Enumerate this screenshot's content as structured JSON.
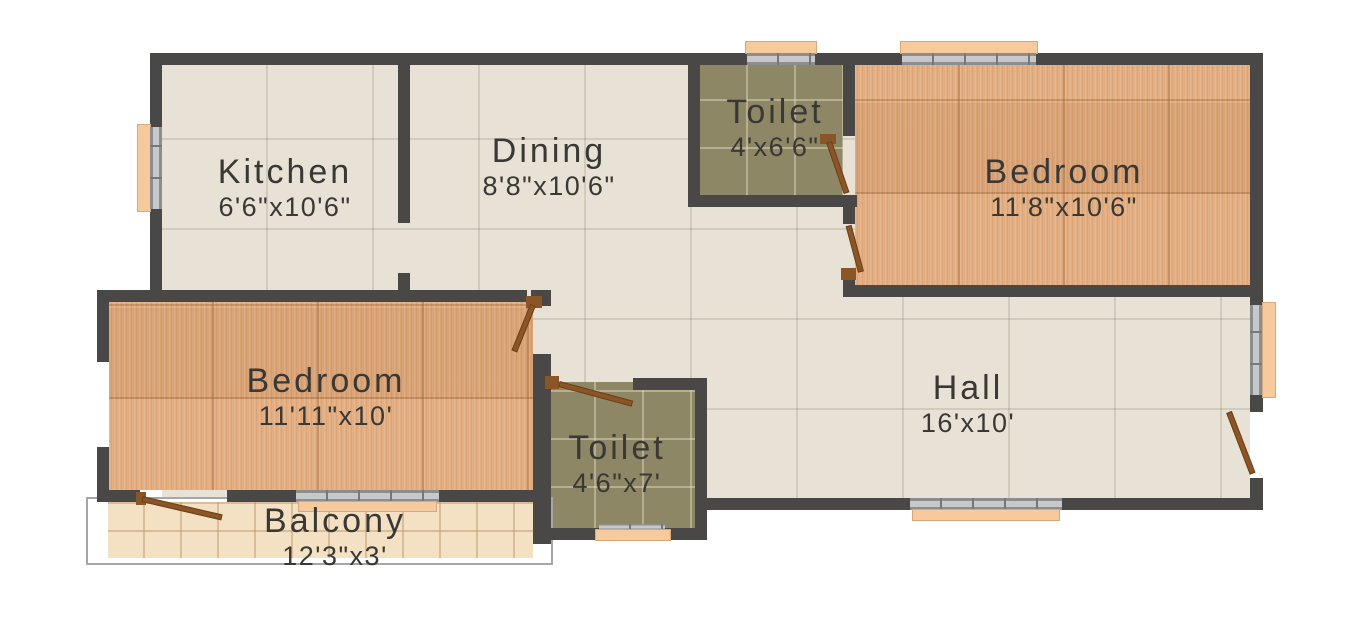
{
  "plan": {
    "rooms": [
      {
        "name": "Kitchen",
        "dimensions": "6'6\"x10'6\""
      },
      {
        "name": "Dining",
        "dimensions": "8'8\"x10'6\""
      },
      {
        "name": "Toilet",
        "dimensions": "4'x6'6\""
      },
      {
        "name": "Bedroom",
        "dimensions": "11'8\"x10'6\""
      },
      {
        "name": "Bedroom",
        "dimensions": "11'11\"x10'"
      },
      {
        "name": "Hall",
        "dimensions": "16'x10'"
      },
      {
        "name": "Toilet",
        "dimensions": "4'6\"x7'"
      },
      {
        "name": "Balcony",
        "dimensions": "12'3\"x3'"
      }
    ],
    "colors": {
      "wall": "#4a4846",
      "tile_floor": "#e7e2d5",
      "wood_floor": "#e2aa7b",
      "toilet_floor": "#8e8765",
      "balcony_floor": "#f4e1c4",
      "window_sill": "#f7ca9e",
      "window_frame": "#9a9c9e",
      "door": "#8a5527",
      "label_text": "#3a3835",
      "background": "#ffffff"
    }
  }
}
